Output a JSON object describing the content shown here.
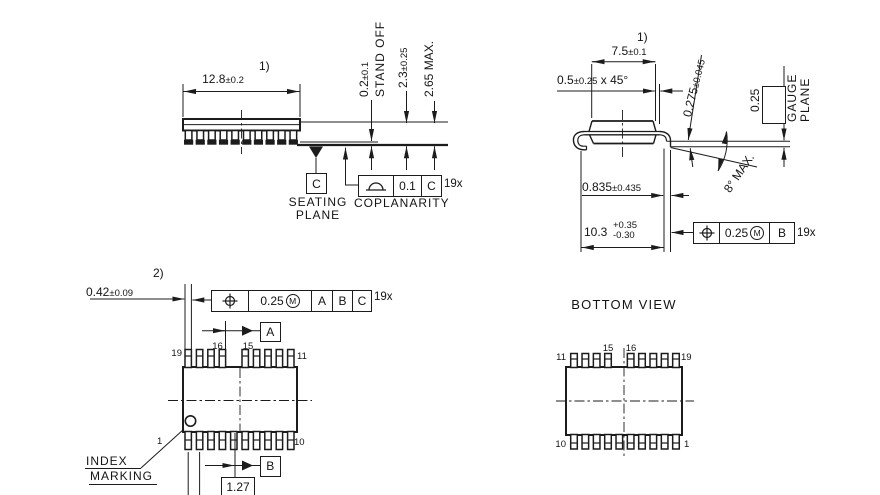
{
  "drawing": {
    "side_view": {
      "note": "1)",
      "body_width": {
        "value": "12.8",
        "tol": "±0.2"
      },
      "standoff": {
        "value": "0.2",
        "tol": "±0.1",
        "label": "STAND OFF"
      },
      "body_height": {
        "value": "2.3",
        "tol": "±0.25"
      },
      "overall_height": {
        "value": "2.65 MAX."
      },
      "seating_plane_label": {
        "line1": "SEATING",
        "line2": "PLANE"
      },
      "datum_c": "C",
      "coplanarity": {
        "label": "COPLANARITY",
        "tolerance": "0.1",
        "datum": "C",
        "count": "19x"
      },
      "leads": 10
    },
    "end_view": {
      "note": "1)",
      "body_width": {
        "value": "7.5",
        "tol": "±0.1"
      },
      "chamfer": {
        "value": "0.5",
        "tol": "±0.25",
        "suffix": " x 45°"
      },
      "lead_thickness": {
        "value": "0.275",
        "tol": "±0.045"
      },
      "gauge_offset": "0.25",
      "gauge_plane_label": {
        "line1": "GAUGE",
        "line2": "PLANE"
      },
      "lead_angle": "8° MAX.",
      "foot_length": {
        "value": "0.835",
        "tol": "±0.435"
      },
      "overall_width": {
        "value": "10.3",
        "tol_plus": "+0.35",
        "tol_minus": "-0.30"
      },
      "position_tol": {
        "tolerance": "0.25",
        "modifier": "M",
        "datum": "B",
        "count": "19x"
      }
    },
    "top_view": {
      "note": "2)",
      "lead_width": {
        "value": "0.42",
        "tol": "±0.09"
      },
      "position_tol": {
        "tolerance": "0.25",
        "modifier": "M",
        "datum1": "A",
        "datum2": "B",
        "datum3": "C",
        "count": "19x"
      },
      "datum_a": "A",
      "datum_b": "B",
      "lead_pitch": "1.27",
      "index_label": {
        "line1": "INDEX",
        "line2": "MARKING"
      },
      "pin_labels": {
        "top_left": "19",
        "top_mid_left": "16",
        "top_mid_right": "15",
        "top_right": "11",
        "bottom_left": "1",
        "bottom_right": "10"
      },
      "pins": {
        "top_leads": 9,
        "bottom_leads": 10,
        "gap_index": 4
      }
    },
    "bottom_view": {
      "title": "BOTTOM VIEW",
      "pin_labels": {
        "top_left": "11",
        "top_mid_left": "15",
        "top_mid_right": "16",
        "top_right": "19",
        "bottom_left": "10",
        "bottom_right": "1"
      },
      "pins": {
        "top_leads": 9,
        "bottom_leads": 10,
        "gap_index": 4
      }
    },
    "colors": {
      "line": "#1c1c1c",
      "text": "#141414",
      "background": "#ffffff"
    }
  }
}
